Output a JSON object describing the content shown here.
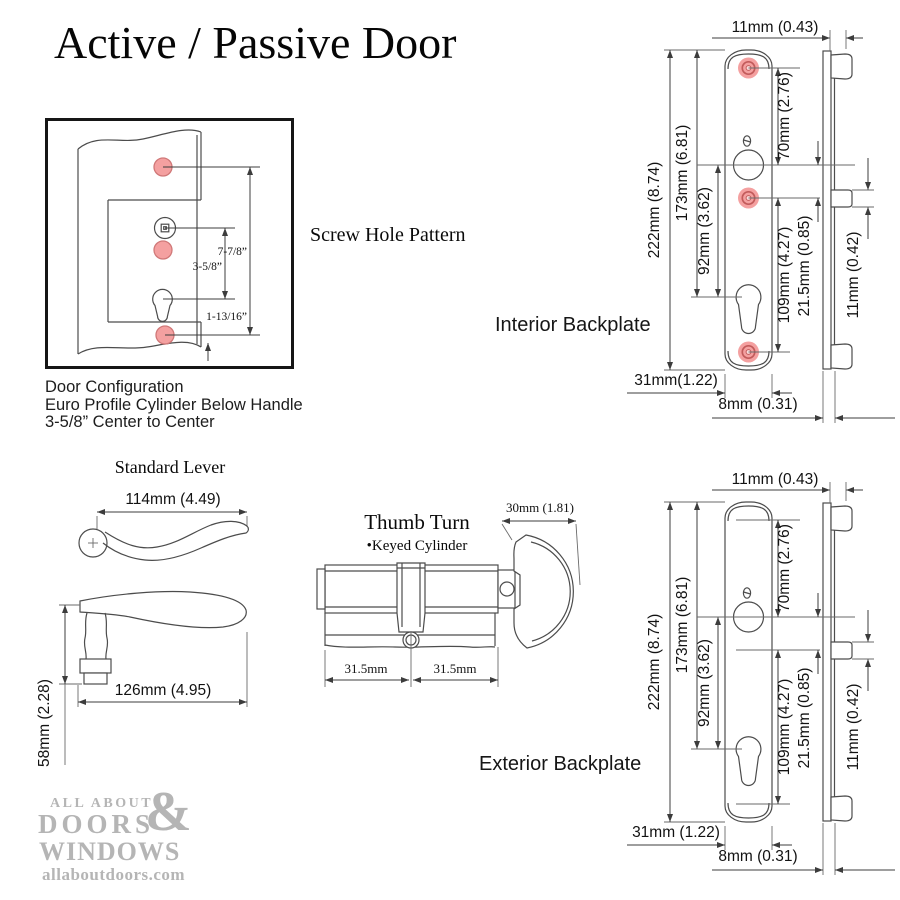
{
  "title": "Active / Passive Door",
  "screw_pattern": {
    "label": "Screw Hole Pattern",
    "dim_overall": "7-7/8”",
    "dim_center": "3-5/8”",
    "dim_bottom": "1-13/16”",
    "caption": [
      "Door Configuration",
      "Euro Profile Cylinder Below Handle",
      "3-5/8” Center to Center"
    ]
  },
  "backplates": {
    "interior_label": "Interior Backplate",
    "exterior_label": "Exterior Backplate",
    "dims": {
      "top_width": "11mm (0.43)",
      "overall": "222mm (8.74)",
      "to_cylinder": "173mm (6.81)",
      "handle_to_cylinder": "92mm (3.62)",
      "screw_to_handle": "70mm (2.76)",
      "screw_span": "109mm (4.27)",
      "handle_to_screw": "21.5mm (0.85)",
      "tab": "11mm (0.42)",
      "plate_width_interior": "31mm(1.22)",
      "plate_width_exterior": "31mm (1.22)",
      "thickness": "8mm (0.31)"
    }
  },
  "lever": {
    "label": "Standard Lever",
    "top_length": "114mm (4.49)",
    "side_length": "126mm (4.95)",
    "height": "58mm (2.28)"
  },
  "cylinder": {
    "label": "Thumb Turn",
    "sublabel": "•Keyed Cylinder",
    "thumb_width": "30mm (1.81)",
    "left_half": "31.5mm",
    "right_half": "31.5mm"
  },
  "logo": {
    "line1": "ALL ABOUT",
    "amp": "&",
    "line2": "DOORS",
    "line3": "WINDOWS",
    "url": "allaboutdoors.com"
  },
  "colors": {
    "screw_hole_fill": "#F4A0A0",
    "screw_hole_ring": "#C25B5B",
    "line": "#3C3C3C",
    "logo_gray": "#B5B5B5"
  }
}
